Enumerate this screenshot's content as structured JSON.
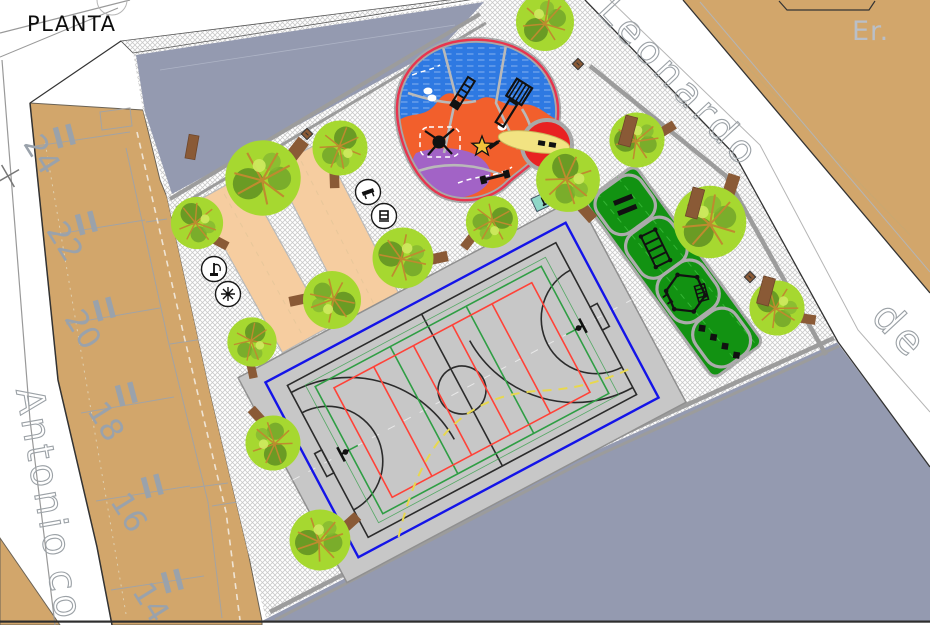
{
  "page_title": "PLANTA",
  "streets": {
    "top_right_upper": "Leonardo",
    "top_right_lower": "de",
    "left_upper": "Antonio",
    "left_lower": "co",
    "adjacent_block_label": "Er."
  },
  "block_left": {
    "plot_numbers": [
      "24",
      "22",
      "20",
      "18",
      "16",
      "14"
    ],
    "storey_marks": [
      "II",
      "II",
      "II",
      "II",
      "II",
      "II"
    ]
  },
  "icons": {
    "furniture_legend": [
      "bench-icon",
      "litter-bin-icon",
      "drinking-fountain-icon",
      "spinner-icon"
    ],
    "site_elements": [
      "tree-icon",
      "bench-icon",
      "litter-bin-icon",
      "play-equipment-icons",
      "fitness-equipment-icons",
      "basketball-hoop-icon"
    ]
  },
  "colors": {
    "street_white": "#FFFFFF",
    "block_tan": "#D2A66B",
    "undeveloped_slate": "#949AB0",
    "paving_hatch": "#C9C9C9",
    "court_surface": "#C7C7C7",
    "court_border_blue": "#1414E8",
    "court_lines_green": "#2F9E44",
    "court_lines_red": "#FF4238",
    "court_arc_yellow": "#E8D84E",
    "playground_blue": "#2E79E2",
    "playground_orange": "#F25F2C",
    "playground_purple": "#A263C6",
    "playground_border_red": "#E8344E",
    "carousel_red": "#E82222",
    "fitness_green": "#129212",
    "petanque_peach": "#F6CDA0",
    "tree_canopy": "#A6D830",
    "wood_brown": "#8A5A36",
    "label_gray": "#9AA2AB"
  }
}
